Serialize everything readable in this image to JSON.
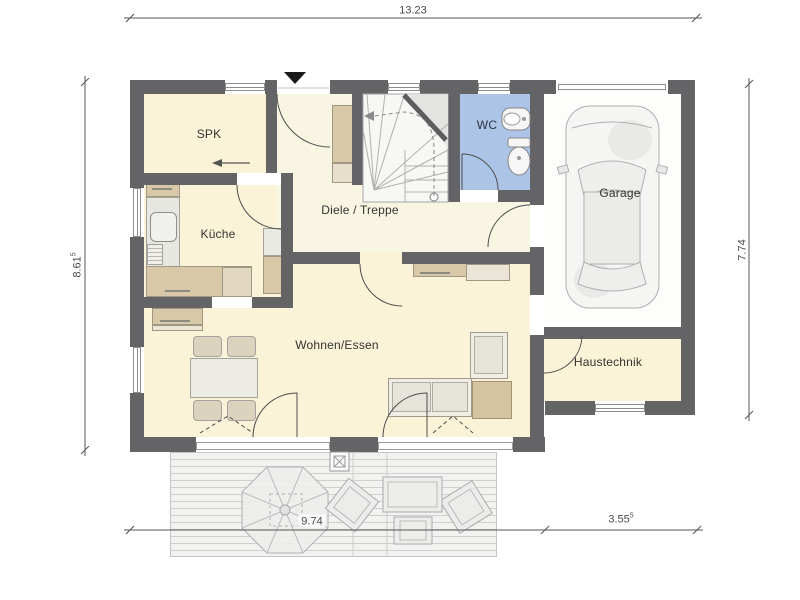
{
  "dimensions": {
    "top": {
      "value": "13.23",
      "sup": ""
    },
    "left": {
      "value": "8.61",
      "sup": "5"
    },
    "right": {
      "value": "7.74",
      "sup": ""
    },
    "bottom_house": {
      "value": "9.74",
      "sup": ""
    },
    "bottom_garage": {
      "value": "3.55",
      "sup": "5"
    }
  },
  "rooms": {
    "spk": "SPK",
    "kueche": "Küche",
    "diele": "Diele / Treppe",
    "wc": "WC",
    "garage": "Garage",
    "wohnen": "Wohnen/Essen",
    "haustechnik": "Haustechnik"
  },
  "icons": {
    "entrance_marker": "black-triangle-entrance-arrow",
    "direction_arrow": "left-arrow",
    "stair_walk_line": "dashed-walking-line",
    "terrace_post": "boxed-x-post"
  },
  "colors": {
    "wall": "#646466",
    "floor_cream": "#fbf3d7",
    "floor_hall": "#f9f5e3",
    "floor_wc": "#acc4e6",
    "floor_garage": "#fdfdfc",
    "furniture_beige": "#d8c8a8",
    "terrace_bg": "#f2f2f0"
  }
}
